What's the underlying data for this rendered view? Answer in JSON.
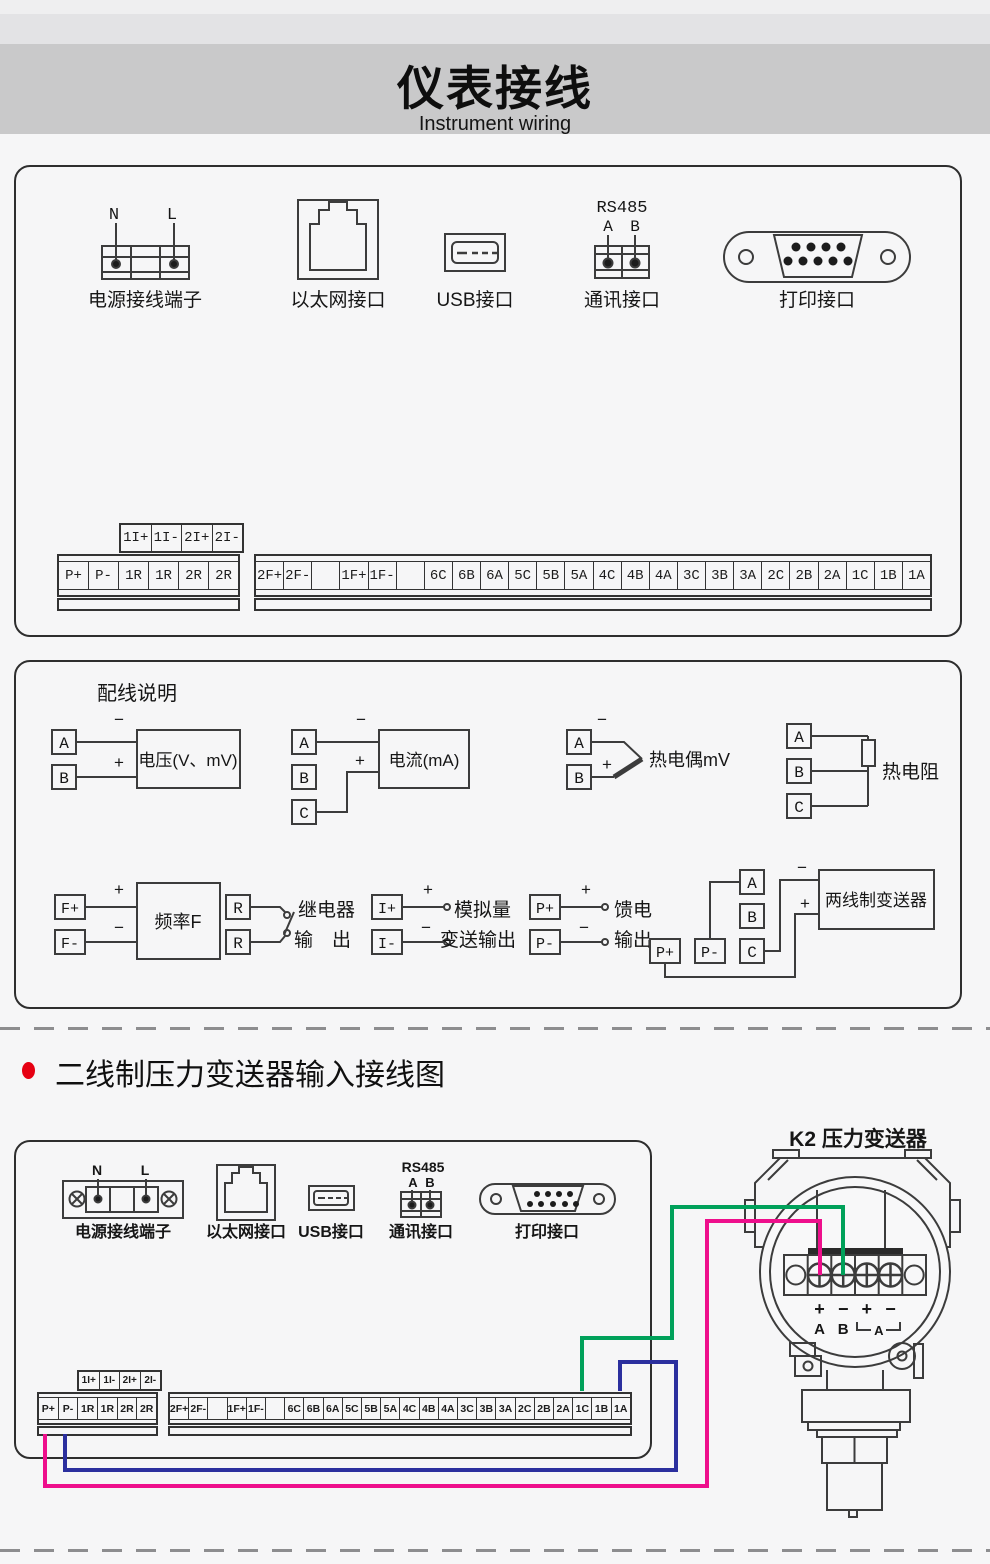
{
  "header": {
    "title": "仪表接线",
    "subtitle": "Instrument wiring"
  },
  "panel1": {
    "power_label": "电源接线端子",
    "power_n": "N",
    "power_l": "L",
    "ethernet_label": "以太网接口",
    "usb_label": "USB接口",
    "comm_label": "通讯接口",
    "comm_bus": "RS485",
    "comm_a": "A",
    "comm_b": "B",
    "printer_label": "打印接口",
    "strip_aux": [
      "1I+",
      "1I-",
      "2I+",
      "2I-"
    ],
    "strip_left": [
      "P+",
      "P-",
      "1R",
      "1R",
      "2R",
      "2R"
    ],
    "strip_right": [
      "2F+",
      "2F-",
      "",
      "1F+",
      "1F-",
      "",
      "6C",
      "6B",
      "6A",
      "5C",
      "5B",
      "5A",
      "4C",
      "4B",
      "4A",
      "3C",
      "3B",
      "3A",
      "2C",
      "2B",
      "2A",
      "1C",
      "1B",
      "1A"
    ]
  },
  "panel2": {
    "title": "配线说明",
    "plus": "+",
    "minus": "−",
    "va": "A",
    "vb": "B",
    "v_label": "电压(V、mV)",
    "ca": "A",
    "cb": "B",
    "cc": "C",
    "c_label": "电流(mA)",
    "ta": "A",
    "tb": "B",
    "t_label": "热电偶mV",
    "ra": "A",
    "rb": "B",
    "rc": "C",
    "r_label": "热电阻",
    "fp": "F+",
    "fm": "F-",
    "f_label": "频率F",
    "rl1": "R",
    "rl2": "R",
    "relay_label1": "继电器",
    "relay_label2": "输　出",
    "ip": "I+",
    "im": "I-",
    "an_label1": "模拟量",
    "an_label2": "变送输出",
    "pp": "P+",
    "pm": "P-",
    "feed_label1": "馈电",
    "feed_label2": "输出",
    "twa": "A",
    "twb": "B",
    "twc": "C",
    "twpp": "P+",
    "twpm": "P-",
    "tw_label": "两线制变送器"
  },
  "section": {
    "heading": "二线制压力变送器输入接线图"
  },
  "panel3": {
    "power_label": "电源接线端子",
    "power_n": "N",
    "power_l": "L",
    "ethernet_label": "以太网接口",
    "usb_label": "USB接口",
    "comm_label": "通讯接口",
    "comm_bus": "RS485",
    "comm_a": "A",
    "comm_b": "B",
    "printer_label": "打印接口",
    "strip_aux": [
      "1I+",
      "1I-",
      "2I+",
      "2I-"
    ],
    "strip_left": [
      "P+",
      "P-",
      "1R",
      "1R",
      "2R",
      "2R"
    ],
    "strip_right": [
      "2F+",
      "2F-",
      "",
      "1F+",
      "1F-",
      "",
      "6C",
      "6B",
      "6A",
      "5C",
      "5B",
      "5A",
      "4C",
      "4B",
      "4A",
      "3C",
      "3B",
      "3A",
      "2C",
      "2B",
      "2A",
      "1C",
      "1B",
      "1A"
    ],
    "transmitter": {
      "title": "K2  压力变送器",
      "t1": "+",
      "t2": "−",
      "t3": "+",
      "t4": "−",
      "pa": "A",
      "pb": "B",
      "pbr": "A"
    }
  },
  "colors": {
    "wire_green": "#00a15a",
    "wire_pink": "#ee0f8c",
    "wire_blue": "#2b2f9e",
    "accent_red": "#e60012"
  }
}
